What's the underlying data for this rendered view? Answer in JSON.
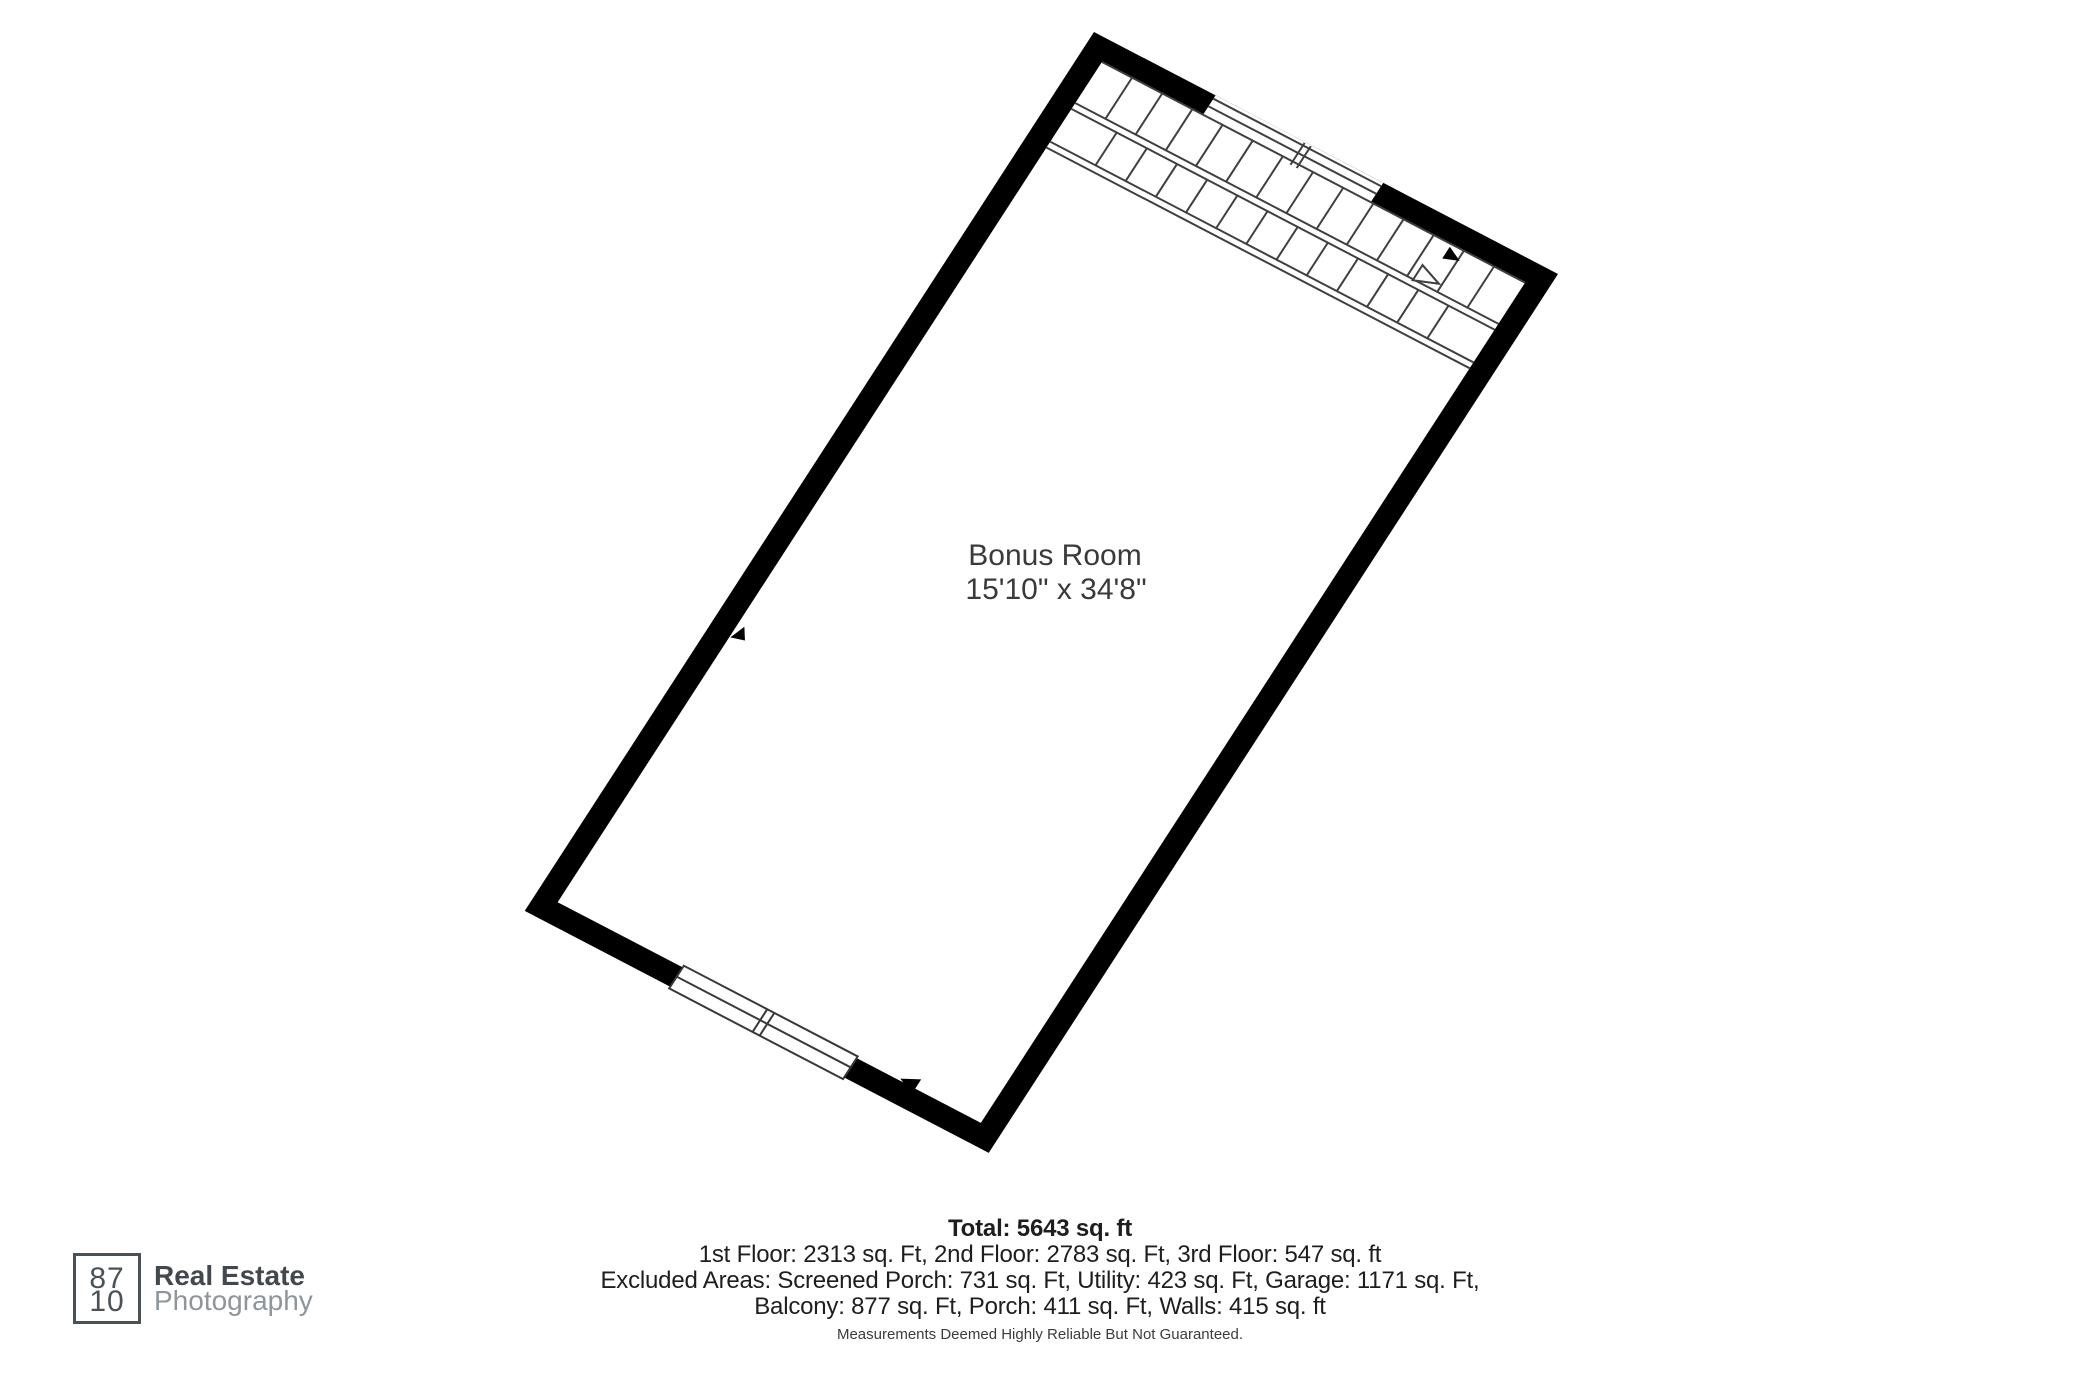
{
  "room": {
    "name": "Bonus Room",
    "dimensions": "15'10\" x 34'8\""
  },
  "summary": {
    "total": "Total: 5643 sq. ft",
    "floors": "1st Floor: 2313 sq. Ft, 2nd Floor: 2783 sq. Ft, 3rd Floor: 547 sq. ft",
    "excluded_1": "Excluded Areas: Screened Porch: 731 sq. Ft, Utility: 423 sq. Ft, Garage: 1171 sq. Ft,",
    "excluded_2": "Balcony: 877 sq. Ft, Porch: 411 sq. Ft, Walls: 415 sq. ft",
    "disclaimer": "Measurements Deemed Highly Reliable But Not Guaranteed."
  },
  "logo": {
    "box_line1": "87",
    "box_line2": "10",
    "brand_line1": "Real Estate",
    "brand_line2": "Photography"
  },
  "colors": {
    "wall": "#000000",
    "floor": "#ffffff",
    "stair_line": "#3f3f3f",
    "room_text": "#3a3a3a",
    "summary_text": "#1e1e1e",
    "logo_dark": "#4b5257",
    "logo_light": "#8e959b"
  }
}
